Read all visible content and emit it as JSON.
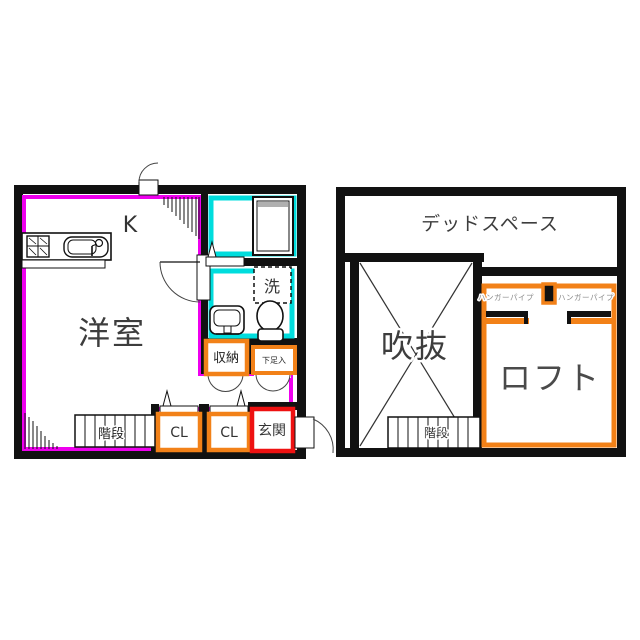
{
  "colors": {
    "wall": "#111111",
    "room_outline_magenta": "#EE00EE",
    "wet_area_outline_cyan": "#00DDDD",
    "storage_outline_orange": "#F28118",
    "entrance_outline_red": "#EE1111",
    "bathtub_inner_gray": "#B0B0B0",
    "hanger_label_gray": "#8A8A8A"
  },
  "left_plan": {
    "kitchen_label": "K",
    "room_label": "洋室",
    "washer_label": "洗",
    "storage_label": "収納",
    "shoe_storage_label": "下足入",
    "closet1_label": "CL",
    "closet2_label": "CL",
    "entrance_label": "玄関",
    "stairs_label": "階段"
  },
  "right_plan": {
    "dead_space_label": "デッドスペース",
    "void_label": "吹抜",
    "loft_label": "ロフト",
    "hanger_pipe_left_label": "ハンガーパイプ",
    "hanger_pipe_right_label": "ハンガーパイプ",
    "stairs_label": "階段"
  }
}
